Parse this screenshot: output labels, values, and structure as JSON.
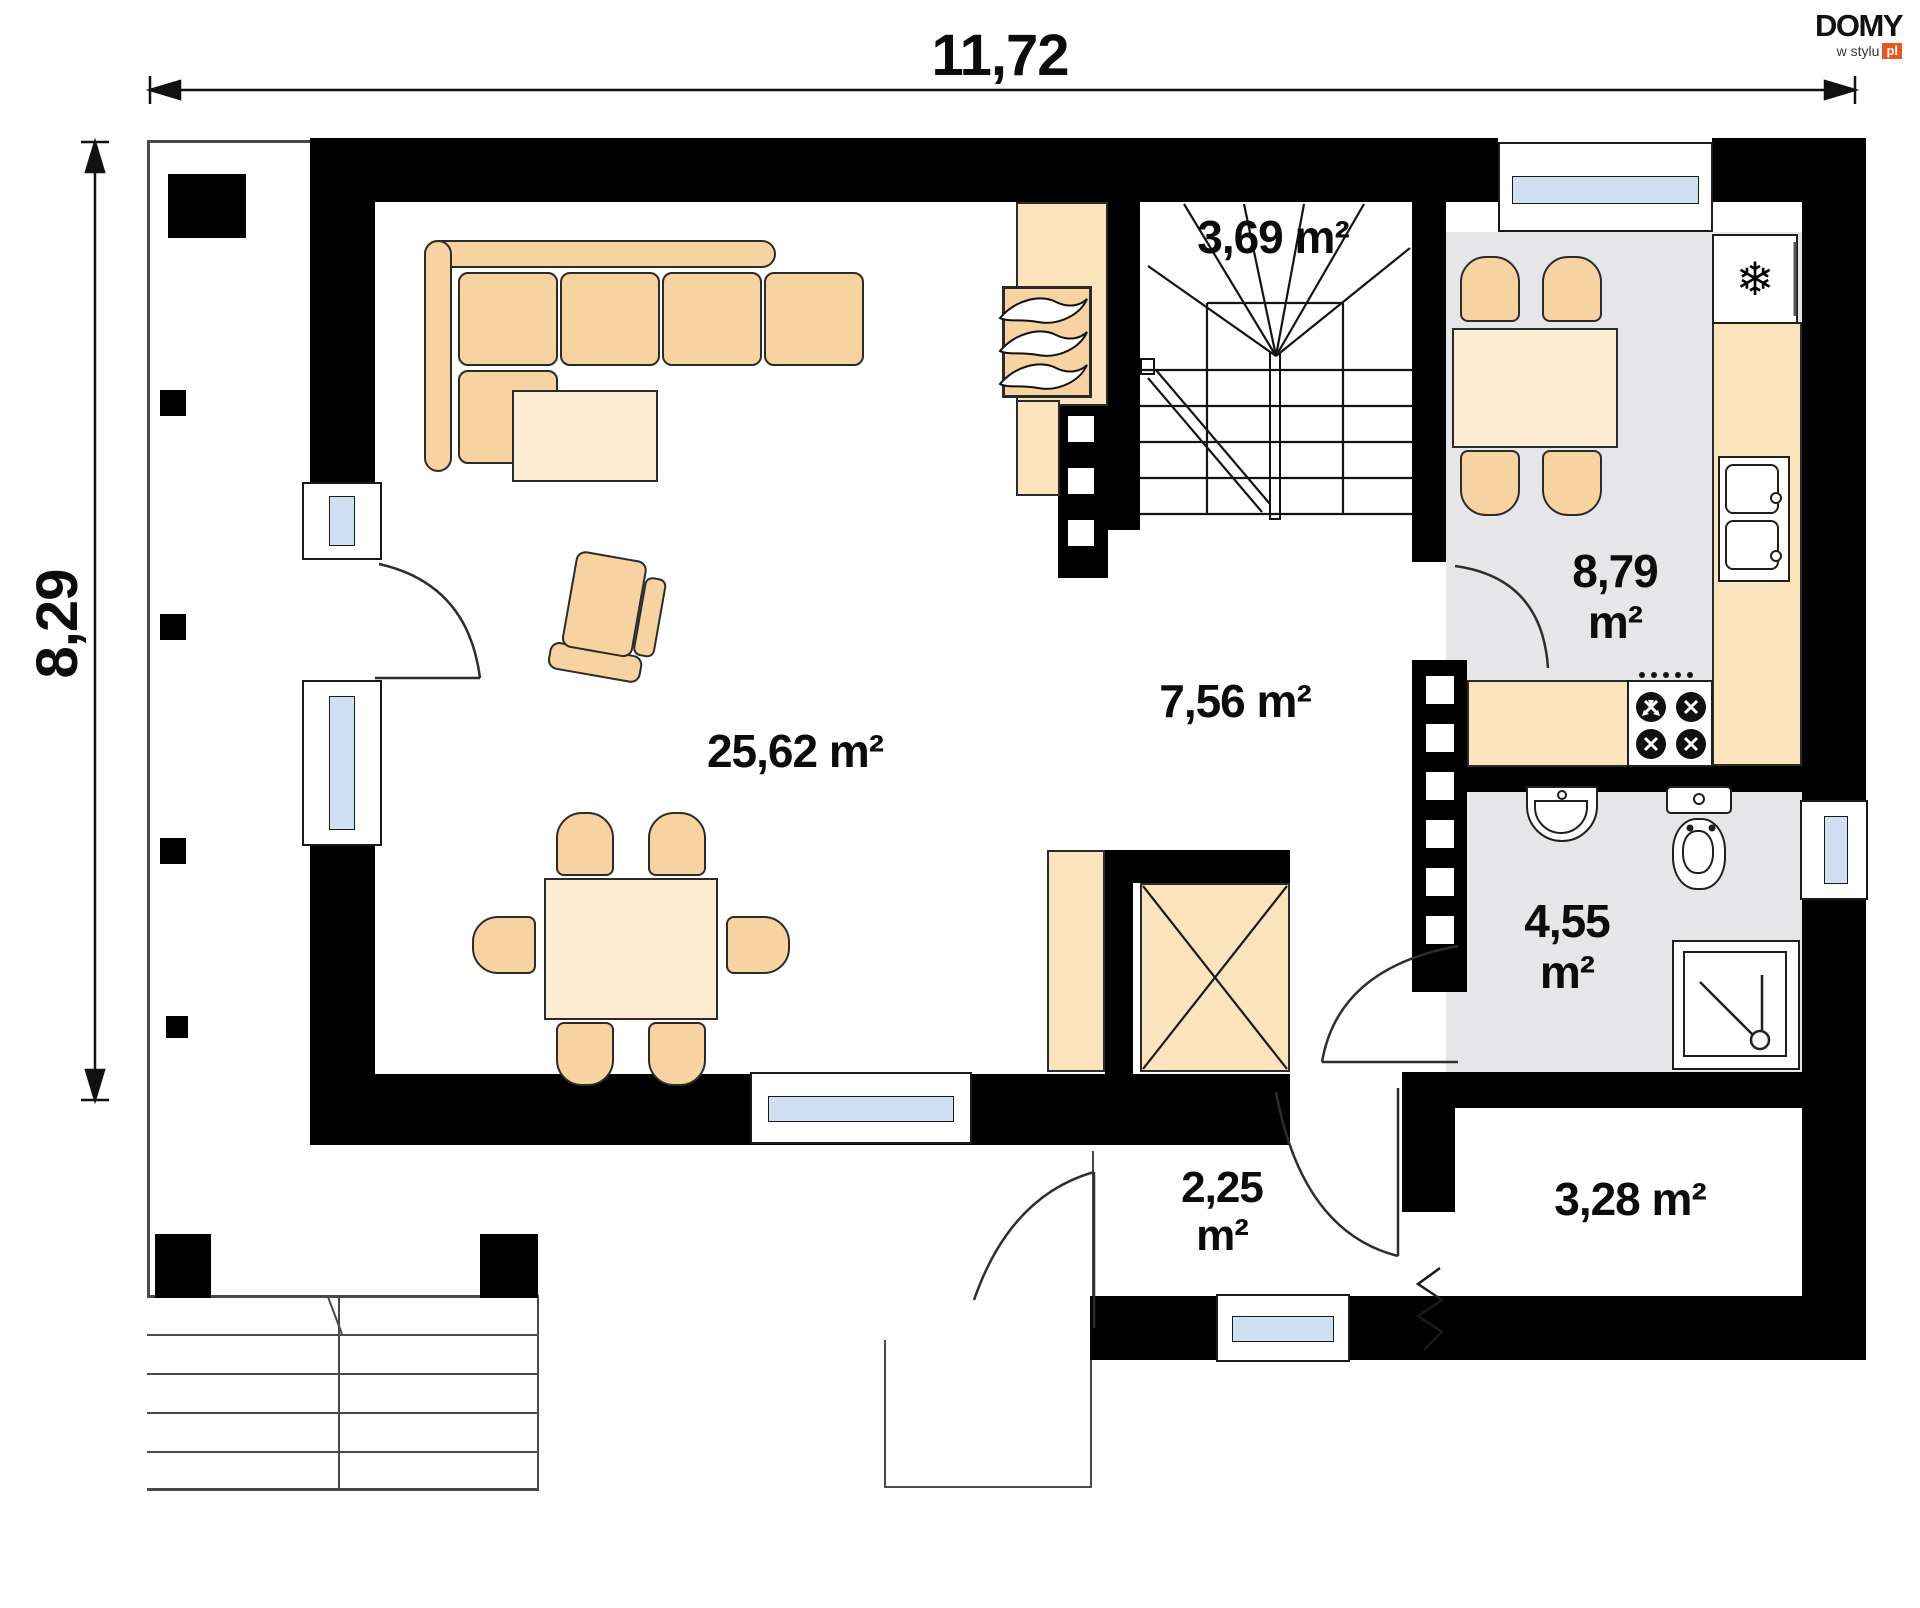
{
  "document": {
    "type": "house floor plan drawing"
  },
  "dimensions": {
    "width_label": "11,72",
    "height_label": "8,29"
  },
  "logo": {
    "title": "DOMY",
    "subtitle": "w stylu",
    "badge": "pl"
  },
  "rooms": {
    "living_room": {
      "area_label": "25,62 m²"
    },
    "hall": {
      "area_label": "7,56 m²"
    },
    "staircase": {
      "area_label": "3,69 m²"
    },
    "kitchen": {
      "area_value": "8,79",
      "area_unit": "m²"
    },
    "bathroom": {
      "area_value": "4,55",
      "area_unit": "m²"
    },
    "vestibule": {
      "area_value": "2,25",
      "area_unit": "m²"
    },
    "storage": {
      "area_label": "3,28 m²"
    }
  },
  "colors": {
    "wall": "#000000",
    "furniture_tan": "#f6d3a0",
    "furniture_light": "#fcecd1",
    "tile_floor": "#e6e6e8",
    "window_glass": "#cfe0f2",
    "logo_badge": "#e8571d"
  },
  "icons": [
    "snowflake-icon",
    "flame-icon",
    "burner-icon",
    "shower-icon",
    "toilet-icon",
    "sink-icon"
  ]
}
